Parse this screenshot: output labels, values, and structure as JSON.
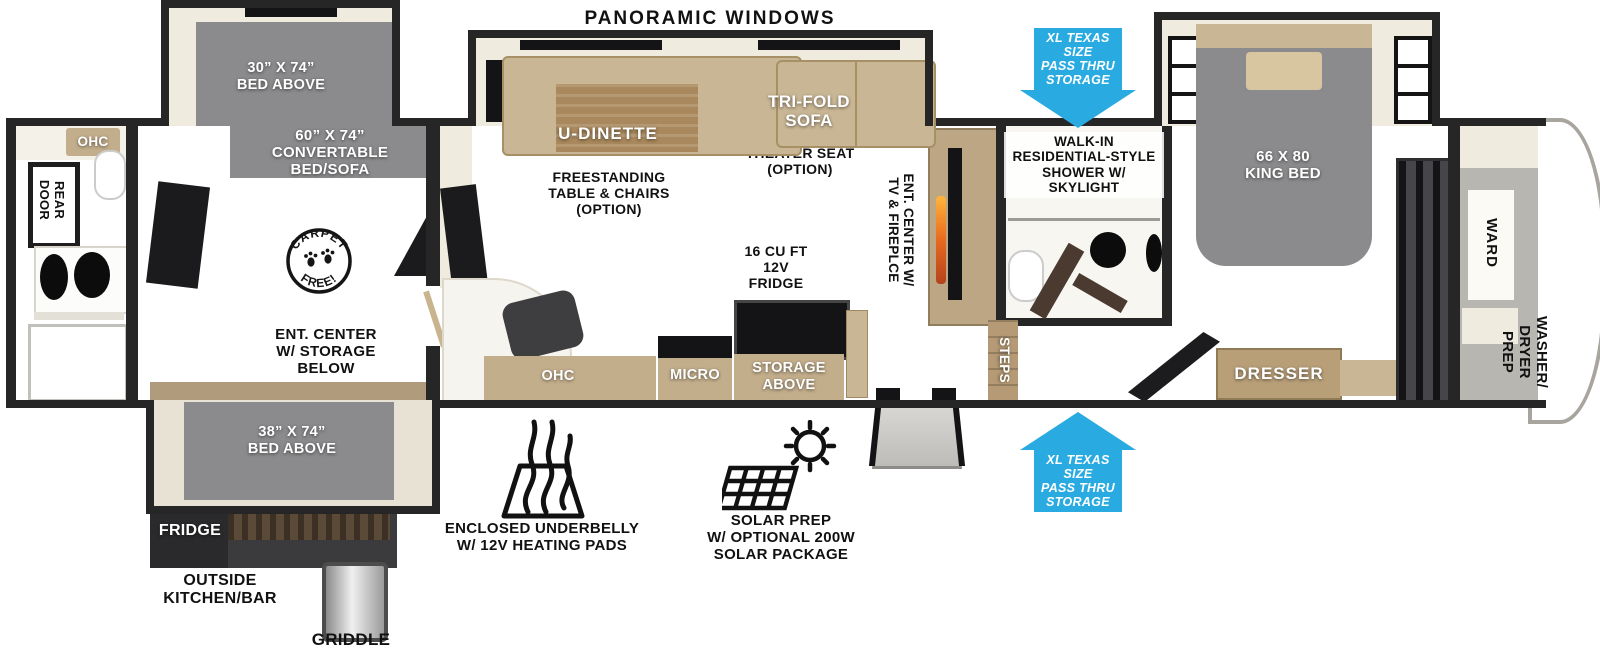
{
  "colors": {
    "accent_blue": "#29ABE2",
    "wall": "#262626",
    "floor_wood": "#D9D1C1",
    "bed_gray": "#8B8B8D",
    "furniture_tan": "#C9B695"
  },
  "top_labels": {
    "panoramic_windows": "PANORAMIC WINDOWS"
  },
  "arrows": {
    "pass_thru": "XL TEXAS SIZE\nPASS THRU\nSTORAGE"
  },
  "rear_bath": {
    "ohc": "OHC",
    "rear_door": "REAR\nDOOR"
  },
  "bunk_area": {
    "bed_above_30": "30” X 74”\nBED ABOVE",
    "convertible_bed": "60” X 74”\nCONVERTABLE\nBED/SOFA",
    "ent_center_storage": "ENT. CENTER\nW/ STORAGE\nBELOW",
    "carpet_free_top": "CARPET",
    "carpet_free_bottom": "FREE!"
  },
  "living_area": {
    "u_dinette": "U-DINETTE",
    "freestanding_table": "FREESTANDING\nTABLE & CHAIRS\n(OPTION)",
    "tri_fold_sofa": "TRI-FOLD\nSOFA",
    "theater_seat": "THEATER SEAT\n(OPTION)",
    "ent_center_tv": "ENT. CENTER W/\nTV & FIREPLCE",
    "fridge_16": "16 CU FT\n12V\nFRIDGE",
    "storage_above": "STORAGE\nABOVE",
    "micro": "MICRO",
    "ohc": "OHC"
  },
  "mid_bath": {
    "walk_in_shower": "WALK-IN\nRESIDENTIAL-STYLE\nSHOWER W/\nSKYLIGHT",
    "steps": "STEPS"
  },
  "bedroom": {
    "king_bed": "66 X 80\nKING BED",
    "dresser": "DRESSER",
    "ward": "WARD",
    "washer_dryer_prep": "WASHER/\nDRYER\nPREP"
  },
  "outside_kitchen": {
    "bed_above_38": "38” X 74”\nBED ABOVE",
    "fridge": "FRIDGE",
    "outside_kitchen_bar": "OUTSIDE\nKITCHEN/BAR",
    "griddle": "GRIDDLE"
  },
  "features": {
    "underbelly": "ENCLOSED UNDERBELLY\nW/ 12V HEATING PADS",
    "solar": "SOLAR PREP\nW/ OPTIONAL 200W\nSOLAR PACKAGE"
  }
}
